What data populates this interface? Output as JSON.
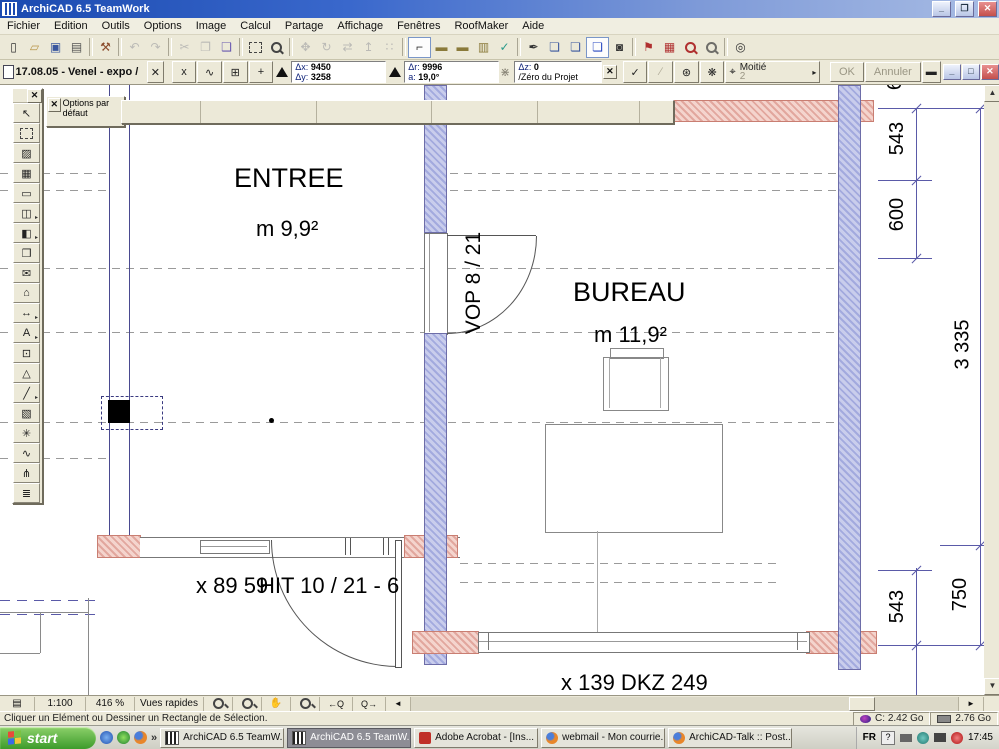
{
  "window": {
    "title": "ArchiCAD 6.5 TeamWork"
  },
  "menu": {
    "items": [
      "Fichier",
      "Edition",
      "Outils",
      "Options",
      "Image",
      "Calcul",
      "Partage",
      "Affichage",
      "Fenêtres",
      "RoofMaker",
      "Aide"
    ]
  },
  "toolbar": {
    "icons": [
      {
        "n": "new-icon",
        "g": "▯"
      },
      {
        "n": "open-icon",
        "g": "▱",
        "c": "#b89548"
      },
      {
        "n": "save-icon",
        "g": "▣",
        "c": "#39569e"
      },
      {
        "n": "print-icon",
        "g": "▤",
        "c": "#555555"
      },
      {
        "sep": true
      },
      {
        "n": "teamwork-icon",
        "g": "⚒",
        "c": "#8a4a2a"
      },
      {
        "sep": true
      },
      {
        "n": "undo-icon",
        "g": "↶",
        "cls": "dis"
      },
      {
        "n": "redo-icon",
        "g": "↷",
        "cls": "dis"
      },
      {
        "sep": true
      },
      {
        "n": "cut-icon",
        "g": "✂",
        "cls": "dis"
      },
      {
        "n": "copy-icon",
        "g": "❐",
        "cls": "dis"
      },
      {
        "n": "paste-icon",
        "g": "❑",
        "c": "#6858b0"
      },
      {
        "sep": true
      },
      {
        "n": "marquee-icon",
        "g": "",
        "cls": "mq"
      },
      {
        "n": "zoom-tool-icon",
        "g": "",
        "cls": "mag"
      },
      {
        "sep": true
      },
      {
        "n": "drag-icon",
        "g": "✥",
        "cls": "dis"
      },
      {
        "n": "rotate-icon",
        "g": "↻",
        "cls": "dis"
      },
      {
        "n": "mirror-icon",
        "g": "⇄",
        "cls": "dis"
      },
      {
        "n": "elevate-icon",
        "g": "↥",
        "cls": "dis"
      },
      {
        "n": "multiply-icon",
        "g": "∷",
        "cls": "dis"
      },
      {
        "sep": true
      },
      {
        "n": "trim-icon",
        "g": "⌐",
        "cls": "pressed"
      },
      {
        "n": "wall-display-icon",
        "g": "▬",
        "c": "#8a7a3a"
      },
      {
        "n": "beam-display-icon",
        "g": "▬",
        "c": "#8a7a3a"
      },
      {
        "n": "column-display-icon",
        "g": "▥",
        "c": "#8a7a3a"
      },
      {
        "n": "layers-icon",
        "g": "✓",
        "c": "#2a9a8a"
      },
      {
        "sep": true
      },
      {
        "n": "pickup-params-icon",
        "g": "✒"
      },
      {
        "n": "copy-settings-icon",
        "g": "❏",
        "c": "#39569e"
      },
      {
        "n": "paste-settings-icon",
        "g": "❏",
        "c": "#39569e"
      },
      {
        "n": "teamwork-changes-icon",
        "g": "❏",
        "cls": "pressed",
        "c": "#2848c0"
      },
      {
        "n": "photo-icon",
        "g": "◙"
      },
      {
        "sep": true
      },
      {
        "n": "markup-icon",
        "g": "⚑",
        "c": "#b03030"
      },
      {
        "n": "toolbox-icon",
        "g": "▦",
        "c": "#b03030"
      },
      {
        "n": "find-select-icon",
        "g": "",
        "cls": "mag red"
      },
      {
        "n": "search-icon",
        "g": "",
        "cls": "mag dis"
      },
      {
        "sep": true
      },
      {
        "n": "origin-icon",
        "g": "◎"
      }
    ]
  },
  "coord_bar": {
    "doc_title": "17.08.05 - Venel - expo /",
    "close_x": "x",
    "btn_x": "x",
    "btn_poly": "∿",
    "btn_grid": "⊞",
    "btn_plus": "+",
    "dx_label": "Δx:",
    "dx_value": "9450",
    "dy_label": "Δy:",
    "dy_value": "3258",
    "dr_label": "Δr:",
    "dr_value": "9996",
    "a_label": "a:",
    "a_value": "19,0°",
    "dz_label": "Δz:",
    "dz_value": "0",
    "origin_label": "/Zéro du Projet",
    "snap_label": "Moitié",
    "snap_value": "2",
    "ok_label": "OK",
    "cancel_label": "Annuler"
  },
  "palettes": {
    "options_label": "Options par défaut"
  },
  "tools": {
    "items": [
      {
        "n": "pointer-tool",
        "g": "↖"
      },
      {
        "n": "marquee-tool",
        "g": "",
        "cls": "mq"
      },
      {
        "n": "wall-tool",
        "g": "▨"
      },
      {
        "n": "column-tool",
        "g": "▦"
      },
      {
        "n": "beam-tool",
        "g": "▭"
      },
      {
        "n": "window-tool",
        "g": "◫",
        "arrow": true
      },
      {
        "n": "door-tool",
        "g": "◧",
        "arrow": true
      },
      {
        "n": "object-tool",
        "g": "❒"
      },
      {
        "n": "picture-tool",
        "g": "✉"
      },
      {
        "n": "roof-tool",
        "g": "⌂"
      },
      {
        "n": "dimension-tool",
        "g": "↔",
        "arrow": true
      },
      {
        "n": "text-tool",
        "g": "A",
        "arrow": true
      },
      {
        "n": "zone-tool",
        "g": "⊡"
      },
      {
        "n": "mesh-tool",
        "g": "△"
      },
      {
        "n": "line-tool",
        "g": "╱",
        "arrow": true
      },
      {
        "n": "figure-tool",
        "g": "▧"
      },
      {
        "n": "hotspot-tool",
        "g": "✳"
      },
      {
        "n": "section-tool",
        "g": "∿"
      },
      {
        "n": "camera-tool",
        "g": "⋔"
      },
      {
        "n": "stair-tool",
        "g": "≣"
      }
    ]
  },
  "plan": {
    "room1_name": "ENTREE",
    "room1_area": "m 9,9²",
    "room2_name": "BUREAU",
    "room2_area": "m 11,9²",
    "door1_label": "VOP 8 / 21",
    "label_x8959": "x 89 59",
    "door2_label": "HIT 10 / 21 - 6",
    "window_label": "x 139 DKZ 249"
  },
  "dims": {
    "top_543": "543",
    "top_600": "600",
    "total": "3 335",
    "bottom_543": "543",
    "bottom_750": "750",
    "partial_top": "6"
  },
  "bottom_bar": {
    "scale": "1:100",
    "zoom": "416 %",
    "quick_views": "Vues rapides",
    "zoom_in": "",
    "zoom_out": "",
    "pan": "✋",
    "fit": "",
    "prev": "←Q",
    "next": "Q→",
    "left_arrow": "◄",
    "right_arrow": "►"
  },
  "status_bar": {
    "message": "Cliquer un Elément ou Dessiner un Rectangle de Sélection.",
    "disk": "C: 2.42 Go",
    "memory": "2.76 Go"
  },
  "taskbar": {
    "start": "start",
    "tasks": [
      {
        "label": "ArchiCAD 6.5 TeamW...",
        "icon": "archicad"
      },
      {
        "label": "ArchiCAD 6.5 TeamW...",
        "icon": "archicad",
        "active": true
      },
      {
        "label": "Adobe Acrobat - [Ins...",
        "icon": "acrobat"
      },
      {
        "label": "webmail - Mon courrie...",
        "icon": "firefox"
      },
      {
        "label": "ArchiCAD-Talk :: Post...",
        "icon": "firefox"
      }
    ],
    "tray": {
      "lang": "FR",
      "help": "?",
      "time": "17:45"
    }
  }
}
